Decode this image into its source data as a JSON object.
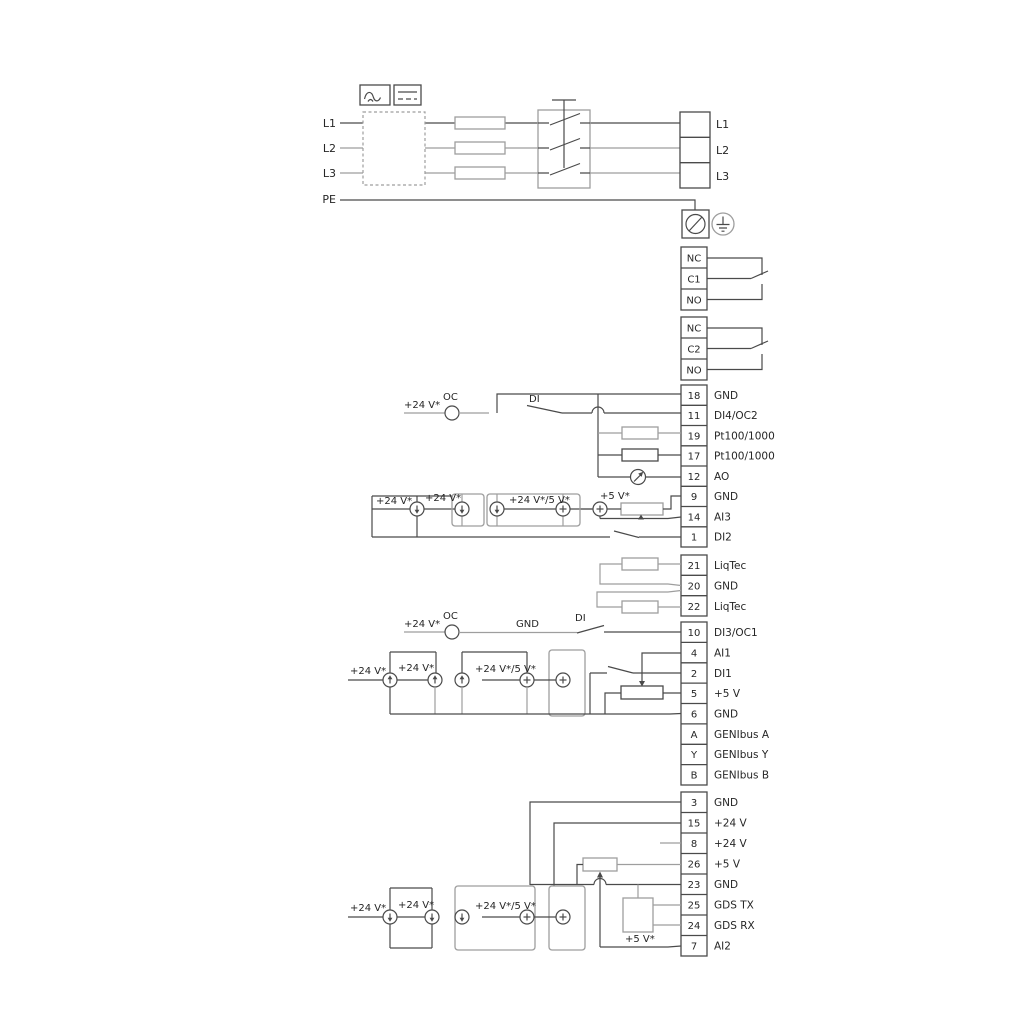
{
  "colors": {
    "wire_dark": "#4a4a4a",
    "wire_gray": "#9e9e9e",
    "text": "#262626",
    "background": "#ffffff"
  },
  "power": {
    "left": [
      "L1",
      "L2",
      "L3",
      "PE"
    ],
    "right": [
      "L1",
      "L2",
      "L3"
    ]
  },
  "relays": [
    {
      "rows": [
        "NC",
        "C1",
        "NO"
      ]
    },
    {
      "rows": [
        "NC",
        "C2",
        "NO"
      ]
    }
  ],
  "strips": {
    "io1": {
      "rows": [
        {
          "num": "18",
          "label": "GND"
        },
        {
          "num": "11",
          "label": "DI4/OC2"
        },
        {
          "num": "19",
          "label": "Pt100/1000"
        },
        {
          "num": "17",
          "label": "Pt100/1000"
        },
        {
          "num": "12",
          "label": "AO"
        },
        {
          "num": "9",
          "label": "GND"
        },
        {
          "num": "14",
          "label": "AI3"
        },
        {
          "num": "1",
          "label": "DI2"
        }
      ]
    },
    "liqtec": {
      "rows": [
        {
          "num": "21",
          "label": "LiqTec"
        },
        {
          "num": "20",
          "label": "GND"
        },
        {
          "num": "22",
          "label": "LiqTec"
        }
      ]
    },
    "io2": {
      "rows": [
        {
          "num": "10",
          "label": "DI3/OC1"
        },
        {
          "num": "4",
          "label": "AI1"
        },
        {
          "num": "2",
          "label": "DI1"
        },
        {
          "num": "5",
          "label": "+5 V"
        },
        {
          "num": "6",
          "label": "GND"
        },
        {
          "num": "A",
          "label": "GENIbus A"
        },
        {
          "num": "Y",
          "label": "GENIbus Y"
        },
        {
          "num": "B",
          "label": "GENIbus B"
        }
      ]
    },
    "io3": {
      "rows": [
        {
          "num": "3",
          "label": "GND"
        },
        {
          "num": "15",
          "label": "+24 V"
        },
        {
          "num": "8",
          "label": "+24 V"
        },
        {
          "num": "26",
          "label": "+5 V"
        },
        {
          "num": "23",
          "label": "GND"
        },
        {
          "num": "25",
          "label": "GDS TX"
        },
        {
          "num": "24",
          "label": "GDS RX"
        },
        {
          "num": "7",
          "label": "AI2"
        }
      ]
    }
  },
  "inline": {
    "v24": "+24 V*",
    "v24v5": "+24 V*/5 V*",
    "v5": "+5 V*",
    "oc": "OC",
    "di": "DI",
    "gnd": "GND"
  }
}
